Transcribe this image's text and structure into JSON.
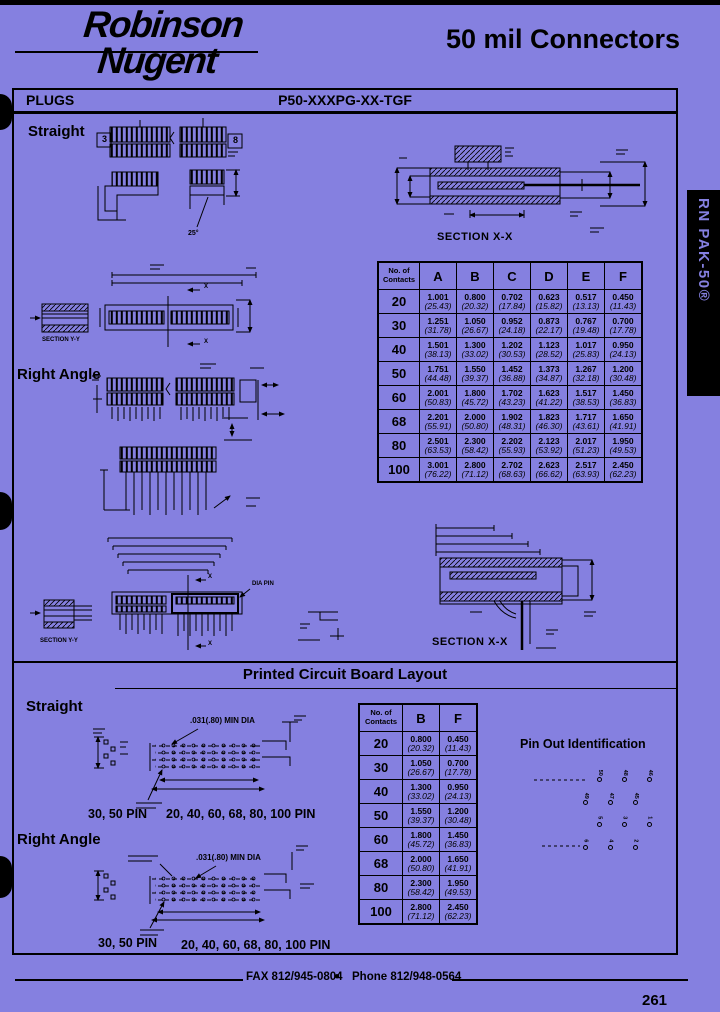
{
  "colors": {
    "background": "#8580E0",
    "ink": "#000000",
    "tab_text": "#8580E0"
  },
  "header": {
    "brand_line1": "Robinson",
    "brand_line2": "Nugent",
    "title": "50 mil Connectors"
  },
  "plugs_bar": {
    "section": "PLUGS",
    "part_number": "P50-XXXPG-XX-TGF"
  },
  "side_tab": {
    "label": "RN PAK-50®"
  },
  "labels": {
    "straight": "Straight",
    "right_angle": "Right Angle",
    "pcb_title": "Printed Circuit Board Layout",
    "pcb_straight": "Straight",
    "pcb_right_angle": "Right Angle",
    "section_xx": "SECTION X-X",
    "section_yy": "SECTION Y-Y",
    "angle_25": "25°",
    "min_dia": ".031(.80) MIN DIA",
    "dia_pin": "DIA PIN",
    "pins_30_50": "30, 50 PIN",
    "pins_rest": "20, 40, 60, 68, 80, 100 PIN",
    "x_marker": "X",
    "balloon_3": "3",
    "balloon_8": "8",
    "pinout_title": "Pin Out Identification"
  },
  "main_table": {
    "header": [
      "No. of\nContacts",
      "A",
      "B",
      "C",
      "D",
      "E",
      "F"
    ],
    "rows": [
      {
        "label": "20",
        "cells": [
          {
            "in": "1.001",
            "mm": "(25.43)"
          },
          {
            "in": "0.800",
            "mm": "(20.32)"
          },
          {
            "in": "0.702",
            "mm": "(17.84)"
          },
          {
            "in": "0.623",
            "mm": "(15.82)"
          },
          {
            "in": "0.517",
            "mm": "(13.13)"
          },
          {
            "in": "0.450",
            "mm": "(11.43)"
          }
        ]
      },
      {
        "label": "30",
        "cells": [
          {
            "in": "1.251",
            "mm": "(31.78)"
          },
          {
            "in": "1.050",
            "mm": "(26.67)"
          },
          {
            "in": "0.952",
            "mm": "(24.18)"
          },
          {
            "in": "0.873",
            "mm": "(22.17)"
          },
          {
            "in": "0.767",
            "mm": "(19.48)"
          },
          {
            "in": "0.700",
            "mm": "(17.78)"
          }
        ]
      },
      {
        "label": "40",
        "cells": [
          {
            "in": "1.501",
            "mm": "(38.13)"
          },
          {
            "in": "1.300",
            "mm": "(33.02)"
          },
          {
            "in": "1.202",
            "mm": "(30.53)"
          },
          {
            "in": "1.123",
            "mm": "(28.52)"
          },
          {
            "in": "1.017",
            "mm": "(25.83)"
          },
          {
            "in": "0.950",
            "mm": "(24.13)"
          }
        ]
      },
      {
        "label": "50",
        "cells": [
          {
            "in": "1.751",
            "mm": "(44.48)"
          },
          {
            "in": "1.550",
            "mm": "(39.37)"
          },
          {
            "in": "1.452",
            "mm": "(36.88)"
          },
          {
            "in": "1.373",
            "mm": "(34.87)"
          },
          {
            "in": "1.267",
            "mm": "(32.18)"
          },
          {
            "in": "1.200",
            "mm": "(30.48)"
          }
        ]
      },
      {
        "label": "60",
        "cells": [
          {
            "in": "2.001",
            "mm": "(50.83)"
          },
          {
            "in": "1.800",
            "mm": "(45.72)"
          },
          {
            "in": "1.702",
            "mm": "(43.23)"
          },
          {
            "in": "1.623",
            "mm": "(41.22)"
          },
          {
            "in": "1.517",
            "mm": "(38.53)"
          },
          {
            "in": "1.450",
            "mm": "(36.83)"
          }
        ]
      },
      {
        "label": "68",
        "cells": [
          {
            "in": "2.201",
            "mm": "(55.91)"
          },
          {
            "in": "2.000",
            "mm": "(50.80)"
          },
          {
            "in": "1.902",
            "mm": "(48.31)"
          },
          {
            "in": "1.823",
            "mm": "(46.30)"
          },
          {
            "in": "1.717",
            "mm": "(43.61)"
          },
          {
            "in": "1.650",
            "mm": "(41.91)"
          }
        ]
      },
      {
        "label": "80",
        "cells": [
          {
            "in": "2.501",
            "mm": "(63.53)"
          },
          {
            "in": "2.300",
            "mm": "(58.42)"
          },
          {
            "in": "2.202",
            "mm": "(55.93)"
          },
          {
            "in": "2.123",
            "mm": "(53.92)"
          },
          {
            "in": "2.017",
            "mm": "(51.23)"
          },
          {
            "in": "1.950",
            "mm": "(49.53)"
          }
        ]
      },
      {
        "label": "100",
        "cells": [
          {
            "in": "3.001",
            "mm": "(76.22)"
          },
          {
            "in": "2.800",
            "mm": "(71.12)"
          },
          {
            "in": "2.702",
            "mm": "(68.63)"
          },
          {
            "in": "2.623",
            "mm": "(66.62)"
          },
          {
            "in": "2.517",
            "mm": "(63.93)"
          },
          {
            "in": "2.450",
            "mm": "(62.23)"
          }
        ]
      }
    ]
  },
  "pcb_table": {
    "header": [
      "No. of\nContacts",
      "B",
      "F"
    ],
    "rows": [
      {
        "label": "20",
        "cells": [
          {
            "in": "0.800",
            "mm": "(20.32)"
          },
          {
            "in": "0.450",
            "mm": "(11.43)"
          }
        ]
      },
      {
        "label": "30",
        "cells": [
          {
            "in": "1.050",
            "mm": "(26.67)"
          },
          {
            "in": "0.700",
            "mm": "(17.78)"
          }
        ]
      },
      {
        "label": "40",
        "cells": [
          {
            "in": "1.300",
            "mm": "(33.02)"
          },
          {
            "in": "0.950",
            "mm": "(24.13)"
          }
        ]
      },
      {
        "label": "50",
        "cells": [
          {
            "in": "1.550",
            "mm": "(39.37)"
          },
          {
            "in": "1.200",
            "mm": "(30.48)"
          }
        ]
      },
      {
        "label": "60",
        "cells": [
          {
            "in": "1.800",
            "mm": "(45.72)"
          },
          {
            "in": "1.450",
            "mm": "(36.83)"
          }
        ]
      },
      {
        "label": "68",
        "cells": [
          {
            "in": "2.000",
            "mm": "(50.80)"
          },
          {
            "in": "1.650",
            "mm": "(41.91)"
          }
        ]
      },
      {
        "label": "80",
        "cells": [
          {
            "in": "2.300",
            "mm": "(58.42)"
          },
          {
            "in": "1.950",
            "mm": "(49.53)"
          }
        ]
      },
      {
        "label": "100",
        "cells": [
          {
            "in": "2.800",
            "mm": "(71.12)"
          },
          {
            "in": "2.450",
            "mm": "(62.23)"
          }
        ]
      }
    ]
  },
  "pinout": {
    "rows": [
      [
        "50",
        "48",
        "46"
      ],
      [
        "49",
        "47",
        "45"
      ],
      [
        "5",
        "3",
        "1"
      ],
      [
        "6",
        "4",
        "2"
      ]
    ]
  },
  "footer": {
    "fax": "FAX 812/945-0804",
    "bullet": "●",
    "phone": "Phone 812/948-0564",
    "page_number": "261"
  }
}
